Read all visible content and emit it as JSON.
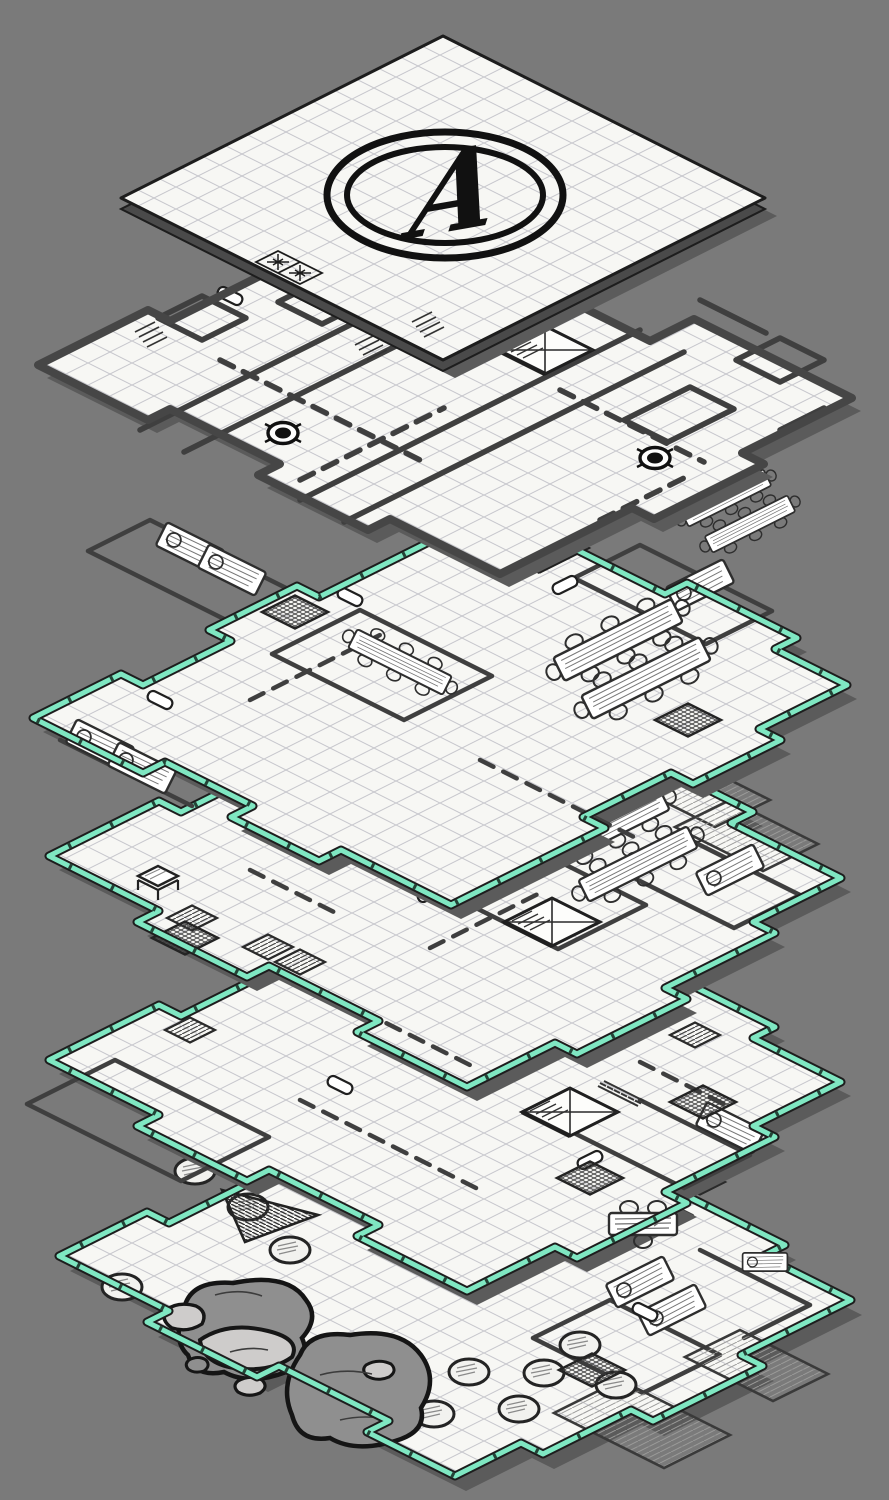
{
  "map": {
    "title": "Isometric multi-level dungeon map",
    "marker_label": "A",
    "level_count": 6,
    "levels": [
      {
        "index": 1,
        "edge_style": "thin dark outline, grey underside",
        "features": [
          "grid",
          "circled letter marker",
          "sparkle stair tiles"
        ]
      },
      {
        "index": 2,
        "edge_style": "thick charcoal outline",
        "features": [
          "corridors",
          "spiral stair",
          "wells",
          "small rooms",
          "dashed passages"
        ]
      },
      {
        "index": 3,
        "edge_style": "teal rim",
        "features": [
          "bunk rooms",
          "long tables with chairs",
          "grates",
          "spiral stair",
          "doors"
        ]
      },
      {
        "index": 4,
        "edge_style": "teal rim",
        "features": [
          "spiral stair",
          "long tables",
          "trapdoor tiles",
          "grate",
          "plank rooms",
          "small table"
        ]
      },
      {
        "index": 5,
        "edge_style": "teal rim",
        "features": [
          "spiral stair",
          "ladder",
          "flat table with chairs",
          "grates",
          "trapdoor tiles"
        ]
      },
      {
        "index": 6,
        "edge_style": "teal rim",
        "features": [
          "pillared hall",
          "boulders",
          "hatched ramp",
          "grates",
          "spiral stair",
          "bunk rooms"
        ]
      }
    ]
  },
  "colors": {
    "background": "#7a7a7a",
    "paper": "#f7f7f4",
    "grid_line": "#c7c7cd",
    "wall_ink": "#3f3f3f",
    "outline_dark": "#1d1d1d",
    "teal_rim": "#7fe7c2",
    "teal_shade": "#2ea77c",
    "drop_shadow": "#5b5b5b",
    "plate_underside": "#4a4a4a",
    "rock": "#8f8f8f",
    "rock_light": "#cecccb",
    "css_vars": "--bg:#7a7a7a;--paper:#f7f7f4;--grid:#c7c7cd;--ink:#3f3f3f;--ink-dark:#1d1d1d;--teal:#7fe7c2;--teal-dark:#2ea77c;--shadow:#5b5b5b;--underside:#4a4a4a;--rock:#8f8f8f;--rock-light:#cecccb"
  },
  "icons": {
    "spiral-stair-icon": "diamond with corner cross and hatched steps",
    "well-icon": "ringed circle with filled centre",
    "sparkle-tile-icon": "two grid cells with four-point stars",
    "grate-icon": "cross-hatched diamond",
    "trapdoor-tile-icon": "line-hatched diamond",
    "pillar-icon": "hatched ellipse column",
    "long-table-icon": "wood-grain table with chairs",
    "bunk-icon": "wood-grain bed with pillow",
    "flat-table-icon": "wood table, top view, with chairs",
    "small-table-icon": "table with legs, side view",
    "door-icon": "white pill on wall",
    "ladder-icon": "rung strip",
    "ramp-icon": "hatched triangle",
    "boulder-icon": "outlined rock blob",
    "scratch-icon": "parallel tick marks"
  }
}
